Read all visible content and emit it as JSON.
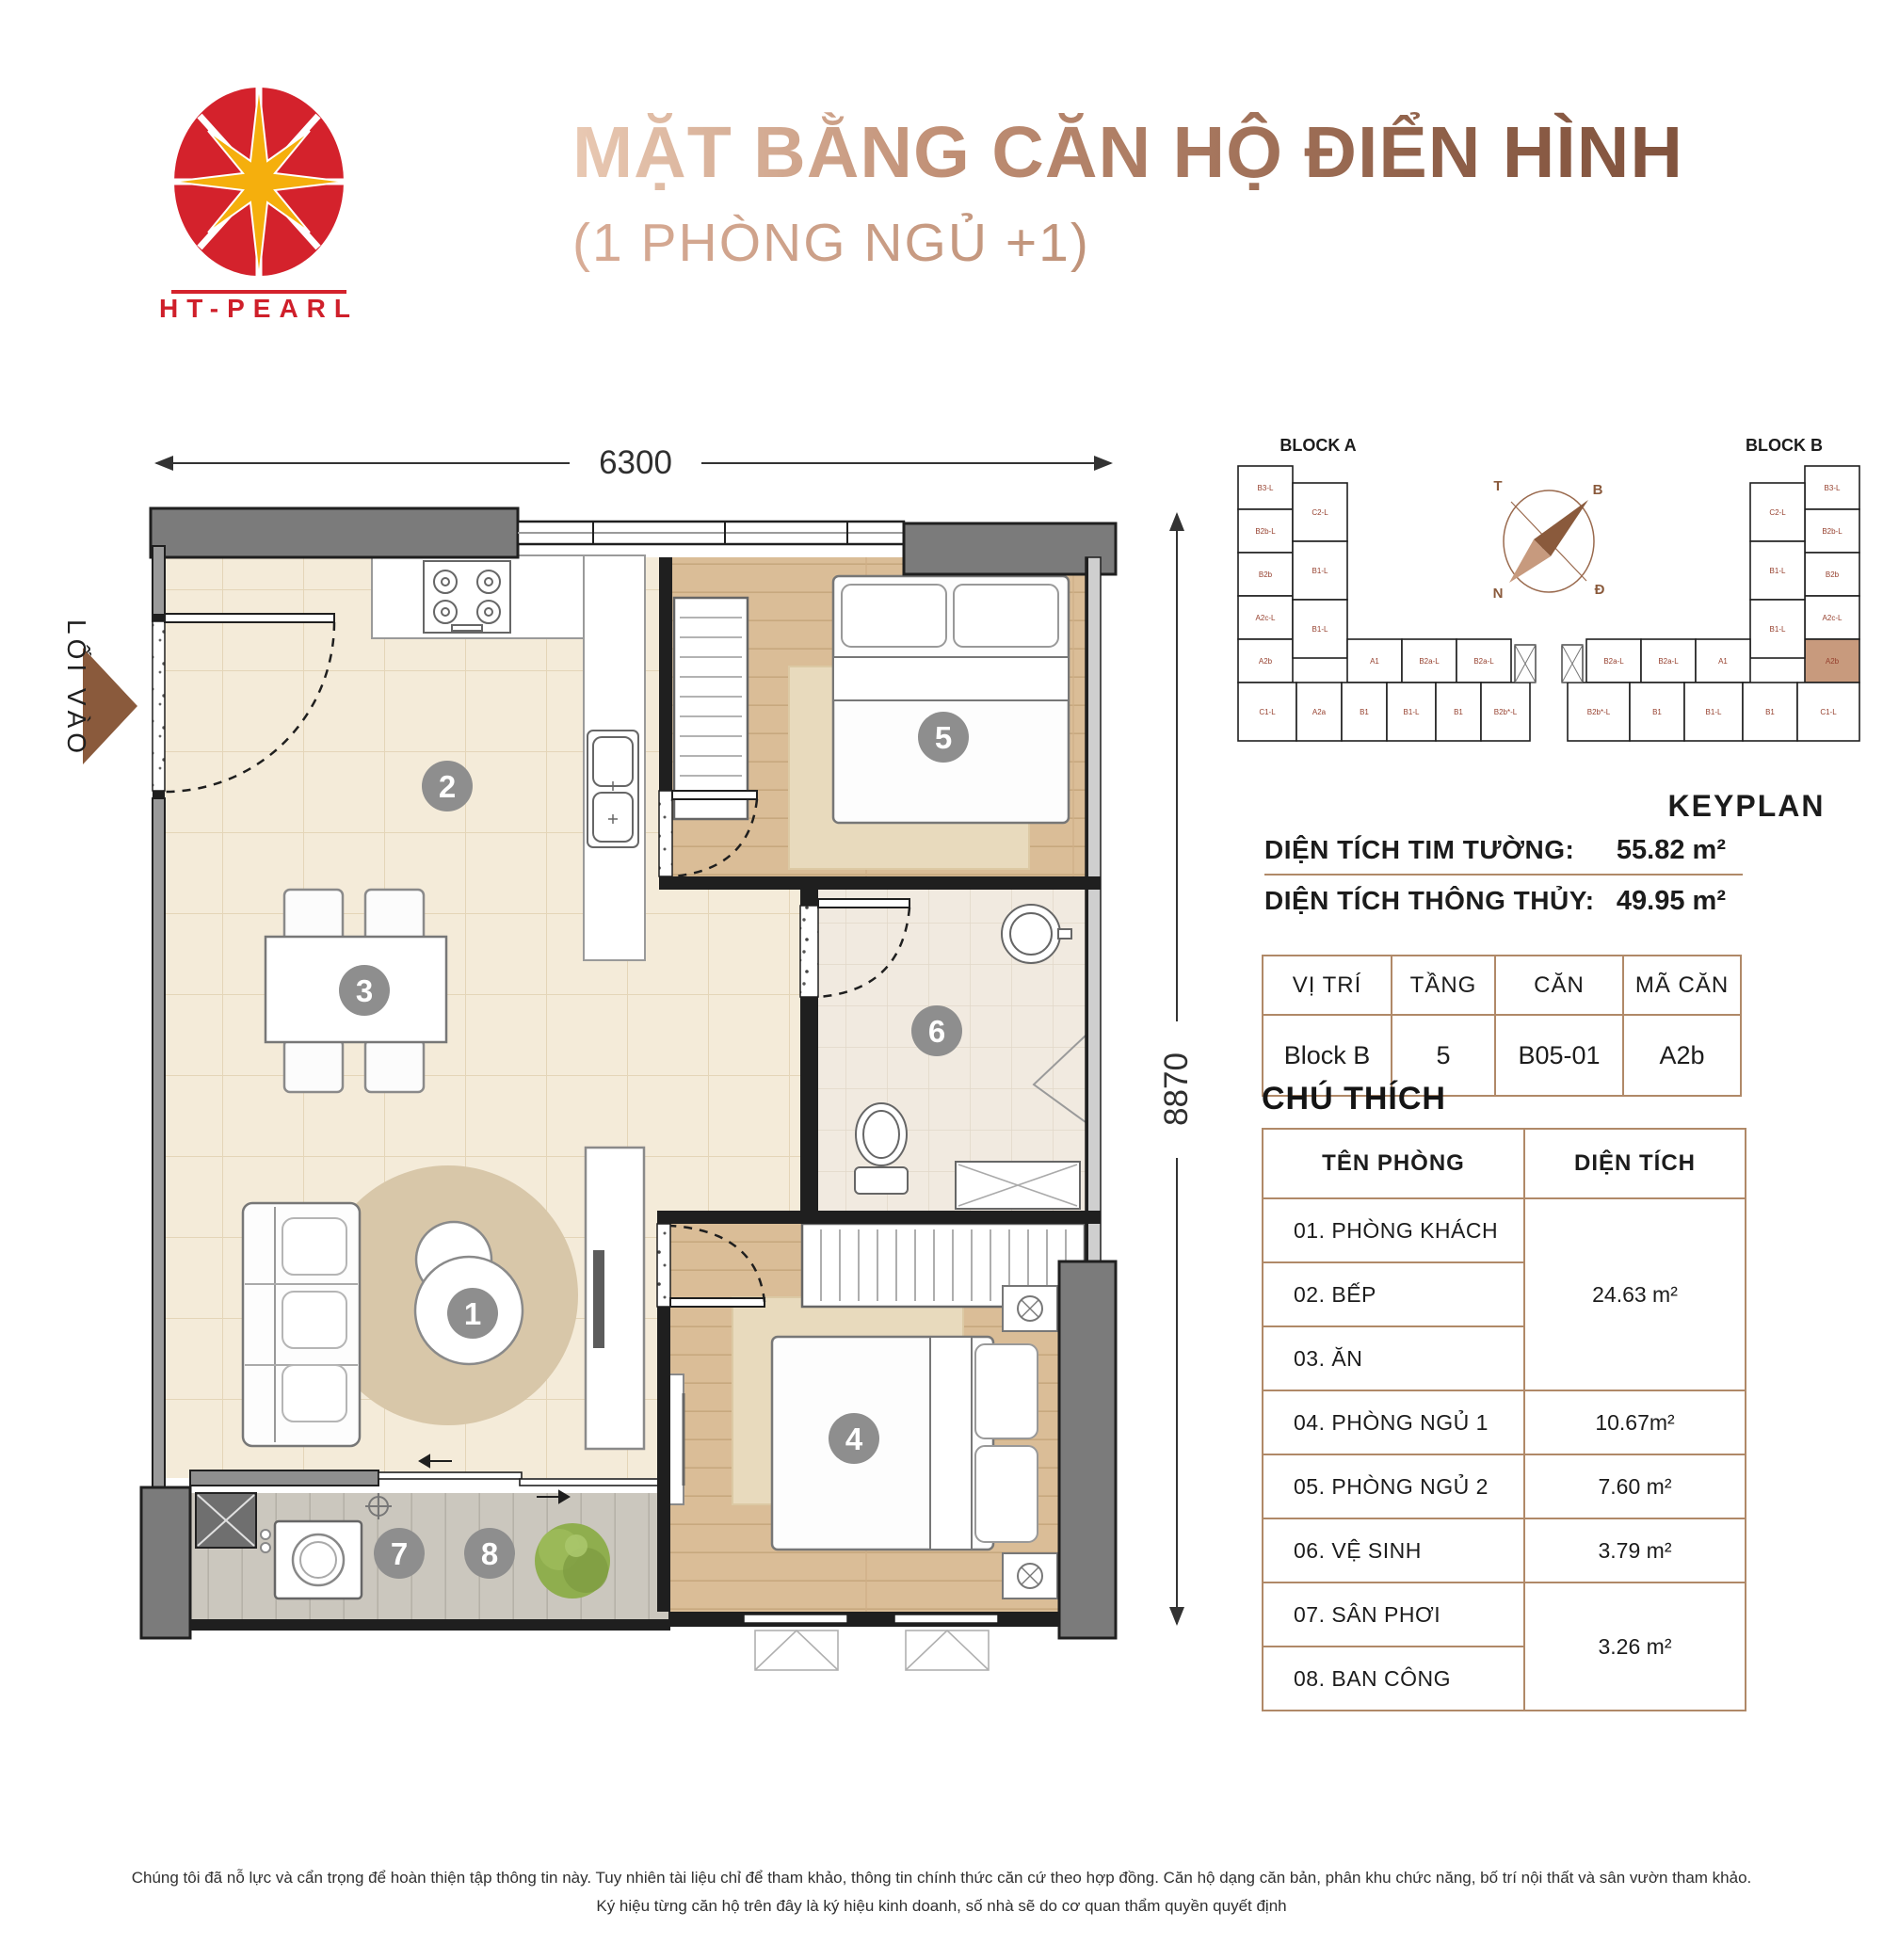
{
  "header": {
    "title": "MẶT BẰNG CĂN HỘ ĐIỂN HÌNH",
    "subtitle": "(1 PHÒNG NGỦ +1)",
    "logo_text": "HT-PEARL"
  },
  "plan": {
    "dim_width": "6300",
    "dim_height": "8870",
    "entrance_label": "LỐI VÀO",
    "badges": [
      "1",
      "2",
      "3",
      "4",
      "5",
      "6",
      "7",
      "8"
    ]
  },
  "keyplan": {
    "block_a_label": "BLOCK A",
    "block_b_label": "BLOCK B",
    "caption": "KEYPLAN",
    "compass": [
      "T",
      "B",
      "N",
      "Đ"
    ],
    "wing_col_outer": [
      "B3-L",
      "B2b-L",
      "B2b",
      "A2c-L",
      "A2b"
    ],
    "wing_col_inner": [
      "C2-L",
      "B1-L",
      "B1-L"
    ],
    "row_a": [
      "C1-L",
      "A2a",
      "B1",
      "B1-L",
      "B1",
      "B2b*-L"
    ],
    "row_a_mid": [
      "A1",
      "B2a-L",
      "B2a-L"
    ],
    "row_b": [
      "B2b*-L",
      "B1",
      "B1-L",
      "B1",
      "C1-L"
    ],
    "row_b_mid": [
      "B2a-L",
      "B2a-L",
      "A1"
    ],
    "highlighted_unit": "A2b",
    "highlight_color": "#c89a7d",
    "label_color": "#96402e"
  },
  "info": {
    "tim_tuong_label": "DIỆN TÍCH TIM TƯỜNG:",
    "tim_tuong_value": "55.82 m²",
    "thong_thuy_label": "DIỆN TÍCH THÔNG THỦY:",
    "thong_thuy_value": "49.95 m²",
    "table": {
      "headers": [
        "VỊ TRÍ",
        "TẦNG",
        "CĂN",
        "MÃ CĂN"
      ],
      "row": [
        "Block B",
        "5",
        "B05-01",
        "A2b"
      ]
    }
  },
  "legend": {
    "title": "CHÚ THÍCH",
    "col_room": "TÊN PHÒNG",
    "col_area": "DIỆN TÍCH",
    "rows": [
      {
        "name": "01. PHÒNG KHÁCH"
      },
      {
        "name": "02. BẾP"
      },
      {
        "name": "03. ĂN"
      },
      {
        "name": "04. PHÒNG NGỦ 1",
        "area": "10.67m²"
      },
      {
        "name": "05. PHÒNG NGỦ 2",
        "area": "7.60 m²"
      },
      {
        "name": "06. VỆ SINH",
        "area": "3.79 m²"
      },
      {
        "name": "07. SÂN PHƠI"
      },
      {
        "name": "08. BAN CÔNG"
      }
    ],
    "merged_area_1_3": "24.63 m²",
    "merged_area_7_8": "3.26 m²"
  },
  "footer": {
    "line1": "Chúng tôi đã nỗ lực và cẩn trọng để hoàn thiện tập thông tin này. Tuy nhiên tài liệu chỉ để tham khảo, thông tin chính thức căn cứ theo hợp đồng. Căn hộ dạng căn bản, phân khu chức năng, bố trí nội thất và sân vườn tham khảo.",
    "line2": "Ký hiệu từng căn hộ trên đây là ký hiệu kinh doanh, số nhà sẽ do cơ quan thẩm quyền quyết định"
  }
}
